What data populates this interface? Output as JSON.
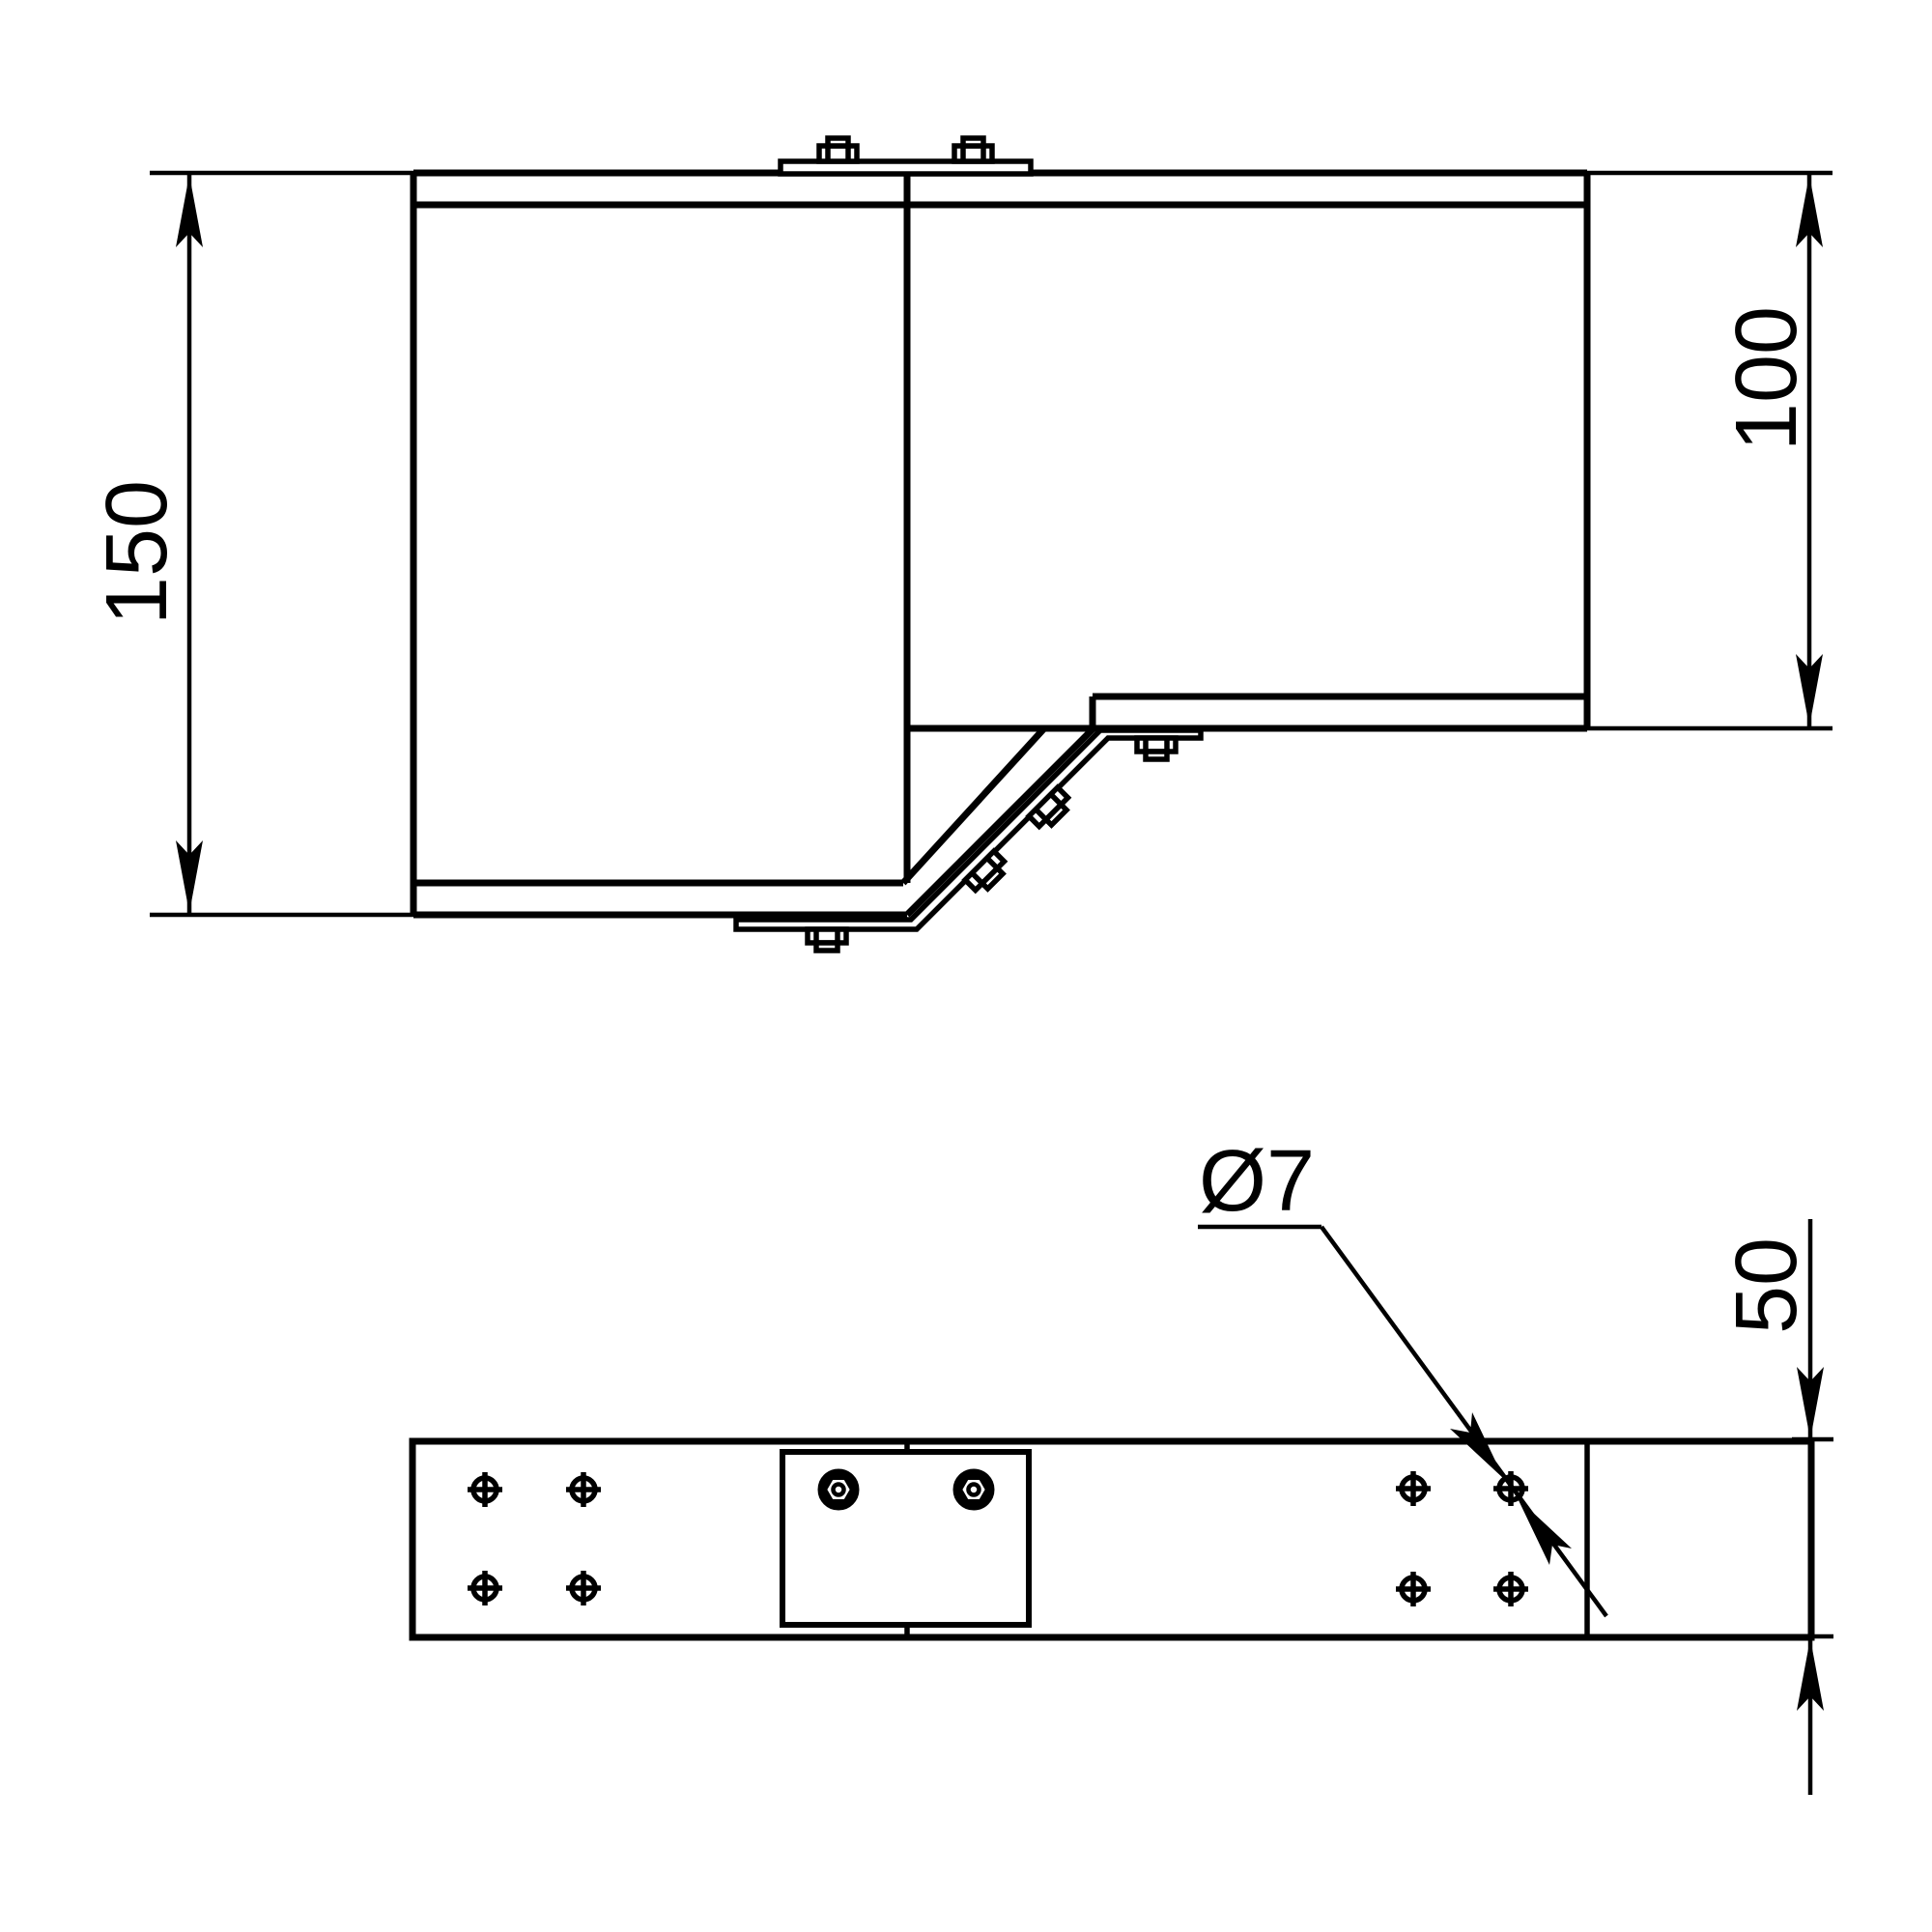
{
  "page": {
    "type": "technical-drawing",
    "background": "#ffffff",
    "line_color": "#000000"
  },
  "side_view": {
    "description": "side elevation of tray reducer with bolted splice plates",
    "dim_height_left": "150",
    "dim_height_right": "100"
  },
  "plan_view": {
    "description": "bottom view of tray reducer",
    "dim_height": "50",
    "hole_callout": "Ø7"
  }
}
